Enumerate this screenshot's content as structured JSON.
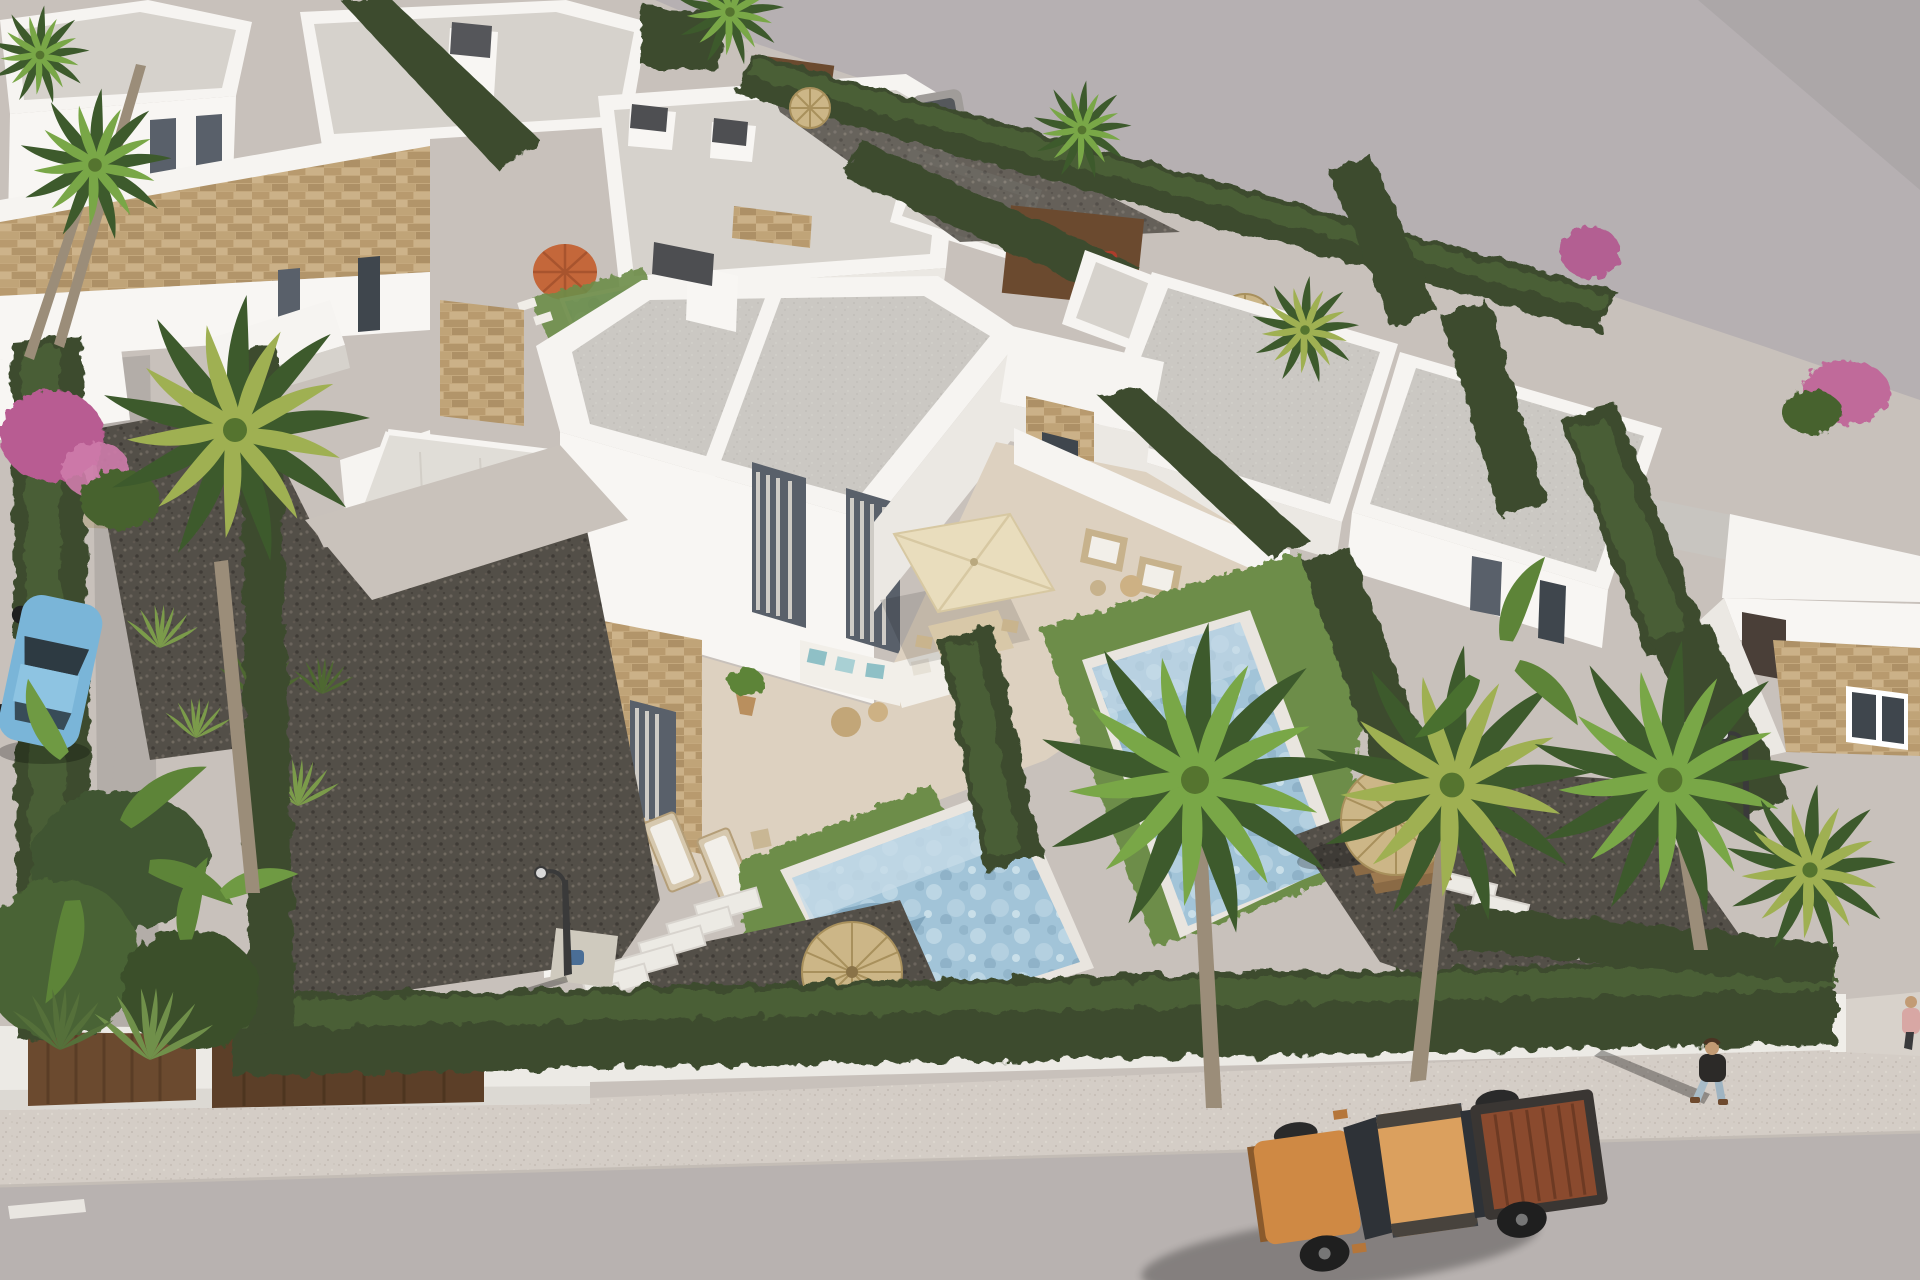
{
  "meta": {
    "type": "3d-architectural-render",
    "subject": "Aerial three-quarter view of a modern white villa development with private pools, hedges and palm trees",
    "width": 1920,
    "height": 1280,
    "visible_text": []
  },
  "palette": {
    "empty_ground": "#b6b0b2",
    "development_ground": "#c8c1bb",
    "road": "#b8b2b0",
    "sidewalk_base": "#d4cdc6",
    "path_concrete": "#c8c1bb",
    "wall_white": "#eceae5",
    "gate_brown": "#6a4a2f",
    "roof_parapet_white": "#f6f4f1",
    "roof_gray": "#cbc8c3",
    "wall_sunlit": "#f8f6f3",
    "wall_shaded": "#ebe8e3",
    "stone_tan": "#c4a87d",
    "window_glass": "#59606a",
    "curtain": "#cfccc6",
    "terrace_beige": "#ddd1c0",
    "hedge_dark": "#3c4c2f",
    "hedge_light": "#4e6339",
    "grass": "#6d8d4a",
    "palm_dark": "#3d5a2c",
    "palm_light": "#79a747",
    "palm_dry": "#9fb052",
    "gravel": "#534f48",
    "pool_water": "#a2c4d8",
    "pool_shallow": "#c6dbe7",
    "pool_coping": "#e9e5df",
    "umbrella_straw": "#ccb687",
    "umbrella_orange": "#c4673a",
    "parasol_cream": "#e9ddbd",
    "truck_body": "#cf8944",
    "truck_roof": "#dba05e",
    "truck_bed": "#8a4a2e",
    "car_blue": "#7ab5d8",
    "car_gray": "#a09c99",
    "quad_red": "#ad3d2c",
    "person_jacket": "#2c2a28",
    "person_jeans": "#a8bcc8",
    "person2_top": "#d8a7a4",
    "skin": "#c29b74"
  },
  "scene": {
    "lighting": {
      "sun_direction": "upper right",
      "shadow_direction": "lower left"
    },
    "buildings": {
      "central_villa": {
        "floors": 2,
        "roof": "flat gray with white parapet and split divider",
        "facade": [
          "white render",
          "travertine stone accent panels"
        ],
        "features": [
          "dark chimney cap",
          "glass balcony",
          "tall curtained windows",
          "tiled lower roof slab",
          "white patio walls"
        ]
      },
      "background_villas_count": 9,
      "right_row": [
        "villa with external solarium stairs",
        "mid villa",
        "far-right villa with stone clad wall and white framed window"
      ]
    },
    "pools": [
      {
        "name": "central-pool",
        "water": "light blue mosaic",
        "feature": "dolphin motif and shallow ledge"
      },
      {
        "name": "right-garden-pool",
        "water": "light blue mosaic"
      },
      {
        "name": "small-back-garden-pool",
        "near": "orange parasol"
      }
    ],
    "vegetation": {
      "palm_trees": 10,
      "cypress_hedge_rows": 14,
      "banana_plants": "bottom-left bed and right garden",
      "bougainvillea_patches": 3,
      "lawn_patches": 3,
      "grass_tufts": "left gravel yard"
    },
    "street": [
      "asphalt road",
      "speckled sidewalk",
      "white perimeter wall",
      "two corten gate panels",
      "white lane dash",
      "driveway entrance right"
    ],
    "street_furniture": [
      "garden lamp post left",
      "garden lamp post right",
      "stepping stone path left",
      "stepping stone path right",
      "concrete pad with blue pool robot"
    ],
    "outdoor_furniture": [
      "white L-sofa with teal cushions",
      "cream dining parasol with table and chairs",
      "two rattan armchairs with side table",
      "two sun loungers",
      "straw parasol by central pool",
      "straw parasol in right garden with picnic table",
      "orange parasol in back garden",
      "two wooden deck chairs",
      "potted plant"
    ],
    "vehicles": [
      {
        "type": "pickup-truck",
        "color": "orange-tan",
        "position": "road bottom right",
        "details": "double cab, open bed with copper liner, dark wheels"
      },
      {
        "type": "hatchback",
        "color": "light blue",
        "position": "left driveway under foliage"
      },
      {
        "type": "car",
        "color": "gray",
        "position": "top parking behind hedge"
      },
      {
        "type": "quad",
        "color": "red",
        "position": "behind brown fence at top"
      }
    ],
    "people": [
      {
        "id": "pedestrian-1",
        "position": "sidewalk right",
        "wearing": "dark jacket, light jeans, brown shoes",
        "shadow": "long, cast to lower left"
      },
      {
        "id": "pedestrian-2",
        "position": "far right edge",
        "wearing": "pink top, dark trousers"
      }
    ]
  }
}
